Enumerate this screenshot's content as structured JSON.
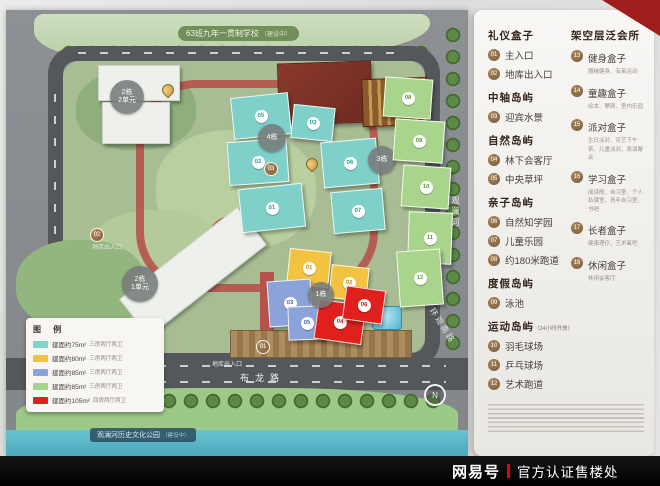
{
  "watermark": {
    "brand": "网易号",
    "divider": "|",
    "label": "官方认证售楼处"
  },
  "map": {
    "school_banner": "63班九年一贯制学校",
    "school_note": "（建设中）",
    "park_label": "观澜河历史文化公园",
    "park_note": "（建设中）",
    "road_bottom": "布龙路",
    "road_right": "观澜河",
    "road_corner": "环观南路",
    "garage_left": "地库出入口",
    "garage_bottom": "地库出入口",
    "compass": "N",
    "towers": {
      "t2u2_line1": "2栋",
      "t2u2_line2": "2单元",
      "t2u1_line1": "2栋",
      "t2u1_line2": "1单元",
      "t1": "1栋",
      "t3": "3栋",
      "t4": "4栋"
    },
    "unit_badges": {
      "teal": [
        "05",
        "03",
        "02",
        "01",
        "06",
        "07"
      ],
      "green": [
        "08",
        "09",
        "10",
        "11",
        "12"
      ],
      "yellow": [
        "01",
        "02"
      ],
      "blue": [
        "03",
        "05"
      ],
      "red": [
        "04",
        "06"
      ]
    },
    "spot_badges": [
      "01",
      "02",
      "03"
    ]
  },
  "map_legend": {
    "title": "图 例",
    "rows": [
      {
        "color": "#7fd4cb",
        "area": "建面约75m²",
        "layout": "三房两厅两卫"
      },
      {
        "color": "#f2c340",
        "area": "建面约80m²",
        "layout": "三房两厅两卫"
      },
      {
        "color": "#8ba3d9",
        "area": "建面约85m²",
        "layout": "三房两厅两卫"
      },
      {
        "color": "#a6d489",
        "area": "建面约85m²",
        "layout": "三房两厅两卫"
      },
      {
        "color": "#e0201c",
        "area": "建面约105m²",
        "layout": "四房两厅两卫"
      }
    ]
  },
  "panel": {
    "col1": [
      {
        "header": "礼仪盒子",
        "suffix": "",
        "items": [
          {
            "no": "01",
            "label": "主入口"
          },
          {
            "no": "02",
            "label": "地库出入口"
          }
        ]
      },
      {
        "header": "中轴岛屿",
        "suffix": "",
        "items": [
          {
            "no": "03",
            "label": "迎宾水景"
          }
        ]
      },
      {
        "header": "自然岛屿",
        "suffix": "",
        "items": [
          {
            "no": "04",
            "label": "林下会客厅"
          },
          {
            "no": "05",
            "label": "中央草坪"
          }
        ]
      },
      {
        "header": "亲子岛屿",
        "suffix": "",
        "items": [
          {
            "no": "06",
            "label": "自然知学园"
          },
          {
            "no": "07",
            "label": "儿童乐园"
          },
          {
            "no": "08",
            "label": "约180米跑道"
          }
        ]
      },
      {
        "header": "度假岛屿",
        "suffix": "",
        "items": [
          {
            "no": "09",
            "label": "泳池"
          }
        ]
      },
      {
        "header": "运动岛屿",
        "suffix": "（24小时开放）",
        "items": [
          {
            "no": "10",
            "label": "羽毛球场"
          },
          {
            "no": "11",
            "label": "乒乓球场"
          },
          {
            "no": "12",
            "label": "艺术跑道"
          }
        ]
      }
    ],
    "col2": {
      "header": "架空层泛会所",
      "items": [
        {
          "no": "13",
          "label": "健身盒子",
          "desc": "器械健身、有氧运动"
        },
        {
          "no": "14",
          "label": "童趣盒子",
          "desc": "绘本、攀爬、室内乐园"
        },
        {
          "no": "15",
          "label": "派对盒子",
          "desc": "生日派对、花艺下午茶、儿童派对、表演聚会"
        },
        {
          "no": "16",
          "label": "学习盒子",
          "desc": "阅读舱、自习室、个人私课室、青年自习室、书吧"
        },
        {
          "no": "17",
          "label": "长者盒子",
          "desc": "健康理疗、艺术氧吧"
        },
        {
          "no": "18",
          "label": "休闲盒子",
          "desc": "休闲会客厅"
        }
      ]
    }
  },
  "colors": {
    "badge_bronze": "#8a6a45",
    "watermark_red": "#e60012",
    "panel_header": "#32241a"
  }
}
